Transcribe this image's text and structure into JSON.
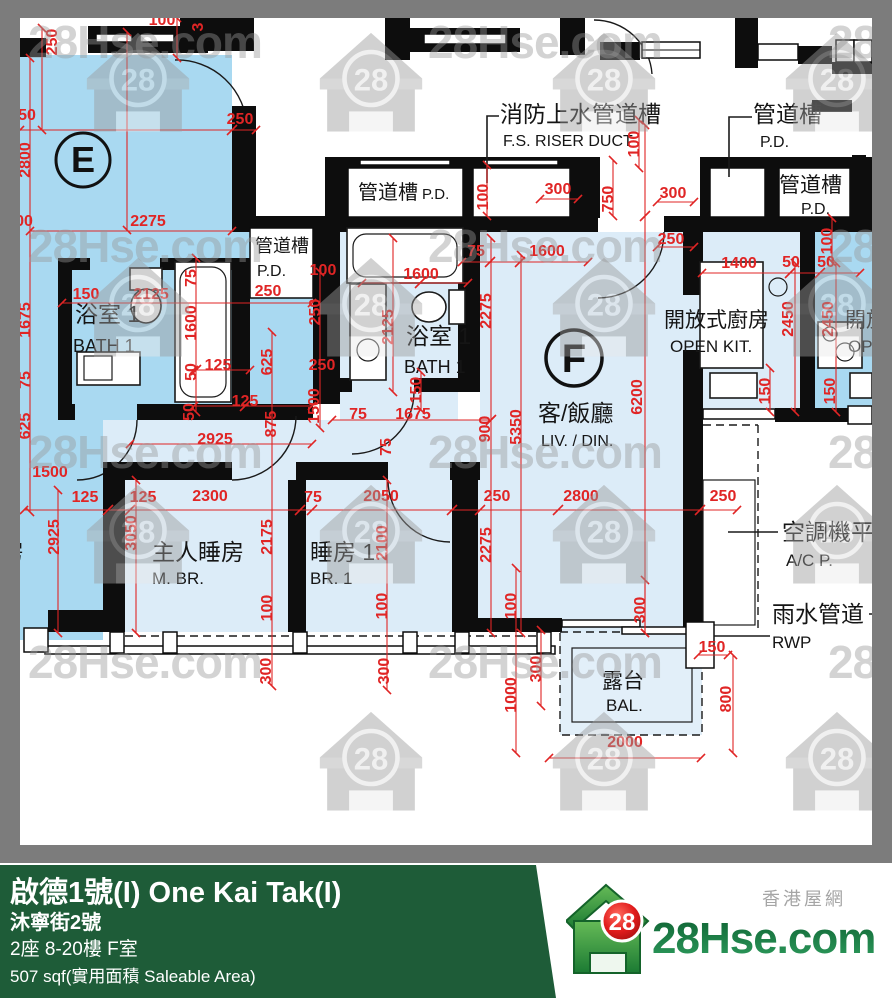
{
  "colors": {
    "frame": "#7c7c7c",
    "bright_room": "#a9d9f1",
    "pale_room": "#dcecf8",
    "dim_red": "#e02525",
    "footer_green": "#1e5c38",
    "brand_green": "#178146"
  },
  "watermark": {
    "text": "28Hse.com",
    "logo_number": "28"
  },
  "footer": {
    "title": "啟德1號(I) One Kai Tak(I)",
    "address": "沐寧街2號",
    "unit": "2座 8-20樓 F室",
    "area": "507 sqf(實用面積 Saleable Area)",
    "brand_number": "28",
    "brand_name": "28Hse.com",
    "brand_tagline": "香港屋網"
  },
  "plan": {
    "units": [
      {
        "label": "E"
      },
      {
        "label": "F"
      }
    ],
    "labels": [
      {
        "id": "bath-e-cn",
        "t": "浴室 1",
        "x": 75,
        "y": 322,
        "s": 23
      },
      {
        "id": "bath-e-en",
        "t": "BATH 1",
        "x": 73,
        "y": 352,
        "s": 18
      },
      {
        "id": "pd-e-cn",
        "t": "管道槽",
        "x": 255,
        "y": 252,
        "s": 18
      },
      {
        "id": "pd-e-en",
        "t": "P.D.",
        "x": 257,
        "y": 276,
        "s": 16
      },
      {
        "id": "pd-mid-cn",
        "t": "管道槽",
        "x": 358,
        "y": 199,
        "s": 20
      },
      {
        "id": "pd-mid-en",
        "t": "P.D.",
        "x": 422,
        "y": 199,
        "s": 15
      },
      {
        "id": "fs-riser-cn",
        "t": "消防上水管道槽",
        "x": 500,
        "y": 122,
        "s": 23
      },
      {
        "id": "fs-riser-en",
        "t": "F.S. RISER DUCT",
        "x": 503,
        "y": 146,
        "s": 16
      },
      {
        "id": "pd-topright-cn",
        "t": "管道槽",
        "x": 753,
        "y": 122,
        "s": 23
      },
      {
        "id": "pd-topright-en",
        "t": "P.D.",
        "x": 760,
        "y": 147,
        "s": 16
      },
      {
        "id": "pd-right-cn",
        "t": "管道槽",
        "x": 779,
        "y": 192,
        "s": 21
      },
      {
        "id": "pd-right-en",
        "t": "P.D.",
        "x": 801,
        "y": 214,
        "s": 16
      },
      {
        "id": "bath-f-cn",
        "t": "浴室 1",
        "x": 406,
        "y": 344,
        "s": 23
      },
      {
        "id": "bath-f-en",
        "t": "BATH 1",
        "x": 404,
        "y": 373,
        "s": 18
      },
      {
        "id": "livdin-cn",
        "t": "客/飯廳",
        "x": 538,
        "y": 421,
        "s": 23
      },
      {
        "id": "livdin-en",
        "t": "LIV. / DIN.",
        "x": 541,
        "y": 446,
        "s": 16
      },
      {
        "id": "openkit-cn",
        "t": "開放式廚房",
        "x": 664,
        "y": 327,
        "s": 21
      },
      {
        "id": "openkit-en",
        "t": "OPEN KIT.",
        "x": 670,
        "y": 352,
        "s": 17
      },
      {
        "id": "bal-cn",
        "t": "露台",
        "x": 602,
        "y": 688,
        "s": 21
      },
      {
        "id": "bal-en",
        "t": "BAL.",
        "x": 606,
        "y": 711,
        "s": 17
      },
      {
        "id": "mbr-cn",
        "t": "主人睡房",
        "x": 152,
        "y": 560,
        "s": 23
      },
      {
        "id": "mbr-en",
        "t": "M. BR.",
        "x": 152,
        "y": 584,
        "s": 17
      },
      {
        "id": "br1-cn",
        "t": "睡房 1",
        "x": 310,
        "y": 560,
        "s": 23
      },
      {
        "id": "br1-en",
        "t": "BR. 1",
        "x": 310,
        "y": 584,
        "s": 17
      },
      {
        "id": "ac-platform-cn",
        "t": "空調機平",
        "x": 782,
        "y": 540,
        "s": 23
      },
      {
        "id": "ac-platform-en",
        "t": "A/C P.",
        "x": 786,
        "y": 566,
        "s": 17
      },
      {
        "id": "rwp-cn",
        "t": "雨水管道",
        "x": 772,
        "y": 622,
        "s": 23
      },
      {
        "id": "rwp-en",
        "t": "RWP",
        "x": 772,
        "y": 648,
        "s": 17
      },
      {
        "id": "neighbor-kit-cn",
        "t": "開放式廚房",
        "x": 845,
        "y": 327,
        "s": 21
      },
      {
        "id": "neighbor-kit-en",
        "t": "OPEN KIT.",
        "x": 848,
        "y": 352,
        "s": 17
      },
      {
        "id": "neighbor-room-cn",
        "t": "房",
        "x": 1,
        "y": 560,
        "s": 23
      }
    ],
    "dims": [
      {
        "t": "100",
        "x": 162,
        "y": 25
      },
      {
        "t": "3",
        "x": 203,
        "y": 27,
        "r": 1
      },
      {
        "t": "250",
        "x": 57,
        "y": 42,
        "r": 1
      },
      {
        "t": "250",
        "x": 240,
        "y": 124
      },
      {
        "t": "50",
        "x": 27,
        "y": 120
      },
      {
        "t": "2800",
        "x": 30,
        "y": 160,
        "r": 1
      },
      {
        "t": "00",
        "x": 24,
        "y": 226
      },
      {
        "t": "2275",
        "x": 148,
        "y": 226
      },
      {
        "t": "1675",
        "x": 30,
        "y": 320,
        "r": 1
      },
      {
        "t": "75",
        "x": 30,
        "y": 380,
        "r": 1
      },
      {
        "t": "625",
        "x": 30,
        "y": 426,
        "r": 1
      },
      {
        "t": "1500",
        "x": 50,
        "y": 477
      },
      {
        "t": "150",
        "x": 86,
        "y": 299
      },
      {
        "t": "2125",
        "x": 151,
        "y": 299
      },
      {
        "t": "75",
        "x": 196,
        "y": 278,
        "r": 1
      },
      {
        "t": "1600",
        "x": 196,
        "y": 323,
        "r": 1
      },
      {
        "t": "250",
        "x": 268,
        "y": 296
      },
      {
        "t": "50",
        "x": 196,
        "y": 372,
        "r": 1
      },
      {
        "t": "125",
        "x": 218,
        "y": 370
      },
      {
        "t": "625",
        "x": 272,
        "y": 362,
        "r": 1
      },
      {
        "t": "50",
        "x": 194,
        "y": 412,
        "r": 1
      },
      {
        "t": "125",
        "x": 245,
        "y": 406
      },
      {
        "t": "875",
        "x": 276,
        "y": 424,
        "r": 1
      },
      {
        "t": "2925",
        "x": 215,
        "y": 444
      },
      {
        "t": "125",
        "x": 85,
        "y": 502
      },
      {
        "t": "125",
        "x": 143,
        "y": 502
      },
      {
        "t": "2300",
        "x": 210,
        "y": 501
      },
      {
        "t": "2925",
        "x": 59,
        "y": 537,
        "r": 1
      },
      {
        "t": "3050",
        "x": 136,
        "y": 533,
        "r": 1
      },
      {
        "t": "2175",
        "x": 272,
        "y": 537,
        "r": 1
      },
      {
        "t": "100",
        "x": 272,
        "y": 608,
        "r": 1
      },
      {
        "t": "300",
        "x": 271,
        "y": 671,
        "r": 1
      },
      {
        "t": "75",
        "x": 313,
        "y": 502
      },
      {
        "t": "2050",
        "x": 381,
        "y": 501
      },
      {
        "t": "250",
        "x": 497,
        "y": 501
      },
      {
        "t": "2800",
        "x": 581,
        "y": 501
      },
      {
        "t": "250",
        "x": 723,
        "y": 501
      },
      {
        "t": "2100",
        "x": 387,
        "y": 543,
        "r": 1
      },
      {
        "t": "2275",
        "x": 491,
        "y": 545,
        "r": 1
      },
      {
        "t": "100",
        "x": 387,
        "y": 606,
        "r": 1
      },
      {
        "t": "300",
        "x": 389,
        "y": 671,
        "r": 1
      },
      {
        "t": "100",
        "x": 516,
        "y": 606,
        "r": 1
      },
      {
        "t": "300",
        "x": 541,
        "y": 669,
        "r": 1
      },
      {
        "t": "1000",
        "x": 516,
        "y": 695,
        "r": 1
      },
      {
        "t": "300",
        "x": 645,
        "y": 610,
        "r": 1
      },
      {
        "t": "150",
        "x": 712,
        "y": 652
      },
      {
        "t": "800",
        "x": 731,
        "y": 699,
        "r": 1
      },
      {
        "t": "2000",
        "x": 625,
        "y": 747
      },
      {
        "t": "2275",
        "x": 491,
        "y": 311,
        "r": 1
      },
      {
        "t": "900",
        "x": 490,
        "y": 429,
        "r": 1
      },
      {
        "t": "5350",
        "x": 521,
        "y": 427,
        "r": 1
      },
      {
        "t": "6200",
        "x": 642,
        "y": 397,
        "r": 1
      },
      {
        "t": "1600",
        "x": 421,
        "y": 279
      },
      {
        "t": "100",
        "x": 323,
        "y": 275
      },
      {
        "t": "250",
        "x": 320,
        "y": 312,
        "r": 1
      },
      {
        "t": "2125",
        "x": 393,
        "y": 327,
        "r": 1
      },
      {
        "t": "250",
        "x": 322,
        "y": 370
      },
      {
        "t": "150",
        "x": 421,
        "y": 390,
        "r": 1
      },
      {
        "t": "1500",
        "x": 319,
        "y": 406,
        "r": 1
      },
      {
        "t": "75",
        "x": 358,
        "y": 419
      },
      {
        "t": "1675",
        "x": 413,
        "y": 419
      },
      {
        "t": "75",
        "x": 391,
        "y": 447,
        "r": 1
      },
      {
        "t": "75",
        "x": 476,
        "y": 256
      },
      {
        "t": "1600",
        "x": 547,
        "y": 256
      },
      {
        "t": "100",
        "x": 488,
        "y": 197,
        "r": 1
      },
      {
        "t": "300",
        "x": 558,
        "y": 194
      },
      {
        "t": "100",
        "x": 639,
        "y": 144,
        "r": 1
      },
      {
        "t": "750",
        "x": 613,
        "y": 199,
        "r": 1
      },
      {
        "t": "300",
        "x": 673,
        "y": 198
      },
      {
        "t": "250",
        "x": 671,
        "y": 244
      },
      {
        "t": "1400",
        "x": 739,
        "y": 268
      },
      {
        "t": "50",
        "x": 791,
        "y": 267
      },
      {
        "t": "50",
        "x": 826,
        "y": 267
      },
      {
        "t": "2450",
        "x": 793,
        "y": 319,
        "r": 1
      },
      {
        "t": "2450",
        "x": 833,
        "y": 319,
        "r": 1
      },
      {
        "t": "150",
        "x": 770,
        "y": 391,
        "r": 1
      },
      {
        "t": "150",
        "x": 835,
        "y": 391,
        "r": 1
      },
      {
        "t": "100",
        "x": 832,
        "y": 241,
        "r": 1
      }
    ]
  }
}
